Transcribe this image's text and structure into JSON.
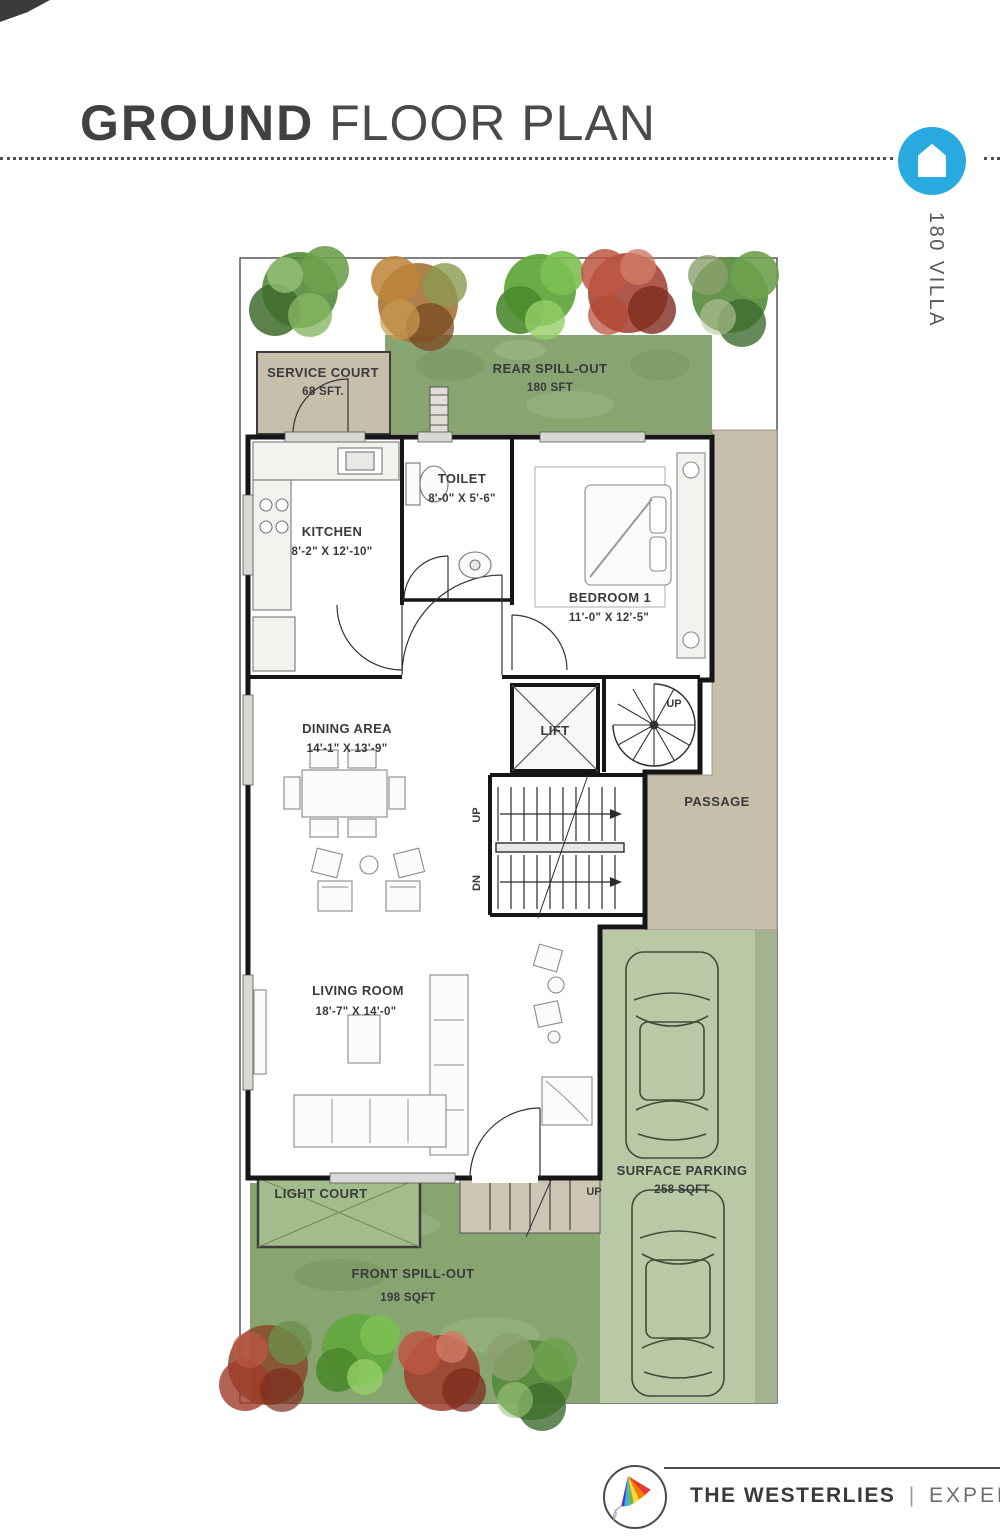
{
  "header": {
    "title_bold": "GROUND",
    "title_rest": "FLOOR PLAN",
    "villa_label": "180 VILLA"
  },
  "rooms": {
    "service_court": {
      "label": "SERVICE COURT",
      "area": "68 SFT."
    },
    "rear_spill_out": {
      "label": "REAR SPILL-OUT",
      "area": "180 SFT"
    },
    "toilet": {
      "label": "TOILET",
      "dims": "8'-0\" X 5'-6\""
    },
    "kitchen": {
      "label": "KITCHEN",
      "dims": "8'-2\" X 12'-10\""
    },
    "bedroom1": {
      "label": "BEDROOM 1",
      "dims": "11'-0\" X 12'-5\""
    },
    "lift": {
      "label": "LIFT"
    },
    "spiral_stair": {
      "label": "UP"
    },
    "passage": {
      "label": "PASSAGE"
    },
    "dining": {
      "label": "DINING AREA",
      "dims": "14'-1\" X 13'-9\""
    },
    "stair": {
      "up": "UP",
      "dn": "DN"
    },
    "living": {
      "label": "LIVING ROOM",
      "dims": "18'-7\" X 14'-0\""
    },
    "parking": {
      "label": "SURFACE PARKING",
      "area": "258 SQFT"
    },
    "light_court": {
      "label": "LIGHT COURT"
    },
    "front_spill_out": {
      "label": "FRONT SPILL-OUT",
      "area": "198 SQFT"
    },
    "entry": {
      "label": "UP"
    }
  },
  "footer": {
    "brand": "THE WESTERLIES",
    "separator": "|",
    "developer": "EXPERION"
  },
  "colors": {
    "accent_blue": "#29aae1",
    "grass_green": "#87a471",
    "parking_green": "#b9c9a5",
    "court_beige": "#c8beac",
    "title_gray": "#414042"
  }
}
